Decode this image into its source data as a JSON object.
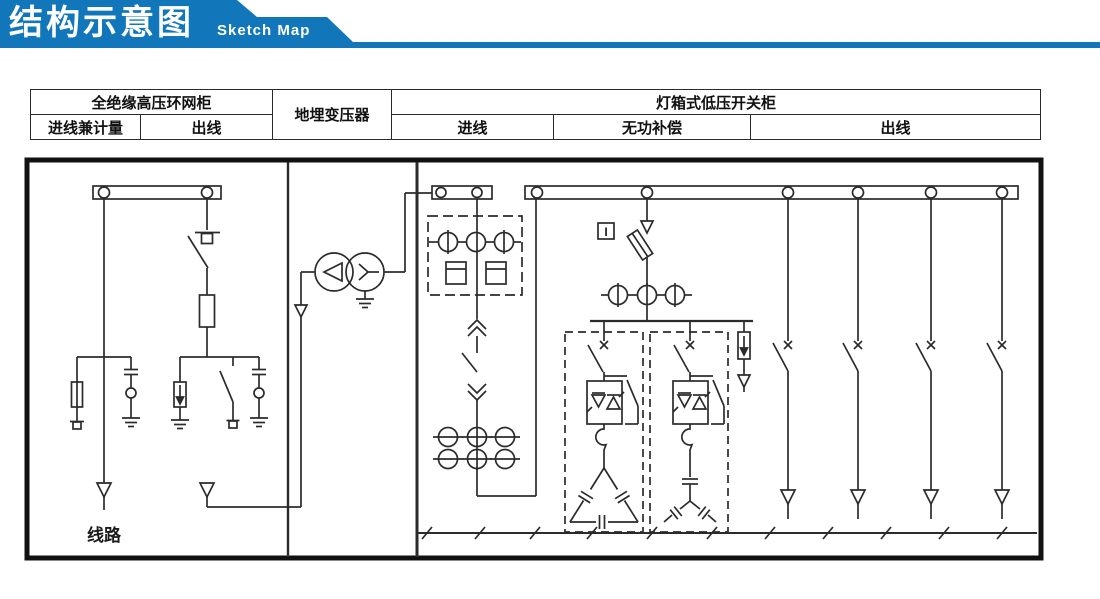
{
  "banner": {
    "title": "结构示意图",
    "subtitle": "Sketch Map",
    "color": "#1277BA"
  },
  "table": {
    "groups": [
      {
        "label": "全绝缘高压环网柜",
        "children": [
          "进线兼计量",
          "出线"
        ]
      },
      {
        "label": "地埋变压器",
        "children": []
      },
      {
        "label": "灯箱式低压开关柜",
        "children": [
          "进线",
          "无功补偿",
          "出线"
        ]
      }
    ]
  },
  "diagram": {
    "line_label": "线路",
    "ammeter_label": "I",
    "line_color": "#2b2b2b",
    "symbols": [
      "hv-busbar",
      "hv-incoming-feeder",
      "voltage-transformer-fuse",
      "capacitive-voltage-indicator",
      "load-break-switch",
      "hv-fuse",
      "surge-arrester",
      "earthing-switch",
      "line-arrow",
      "transformer-delta-wye",
      "ground",
      "lv-incoming-busbar",
      "metering-current-transformers",
      "energy-meters",
      "withdrawable-circuit-breaker",
      "current-transformers",
      "lv-main-busbar",
      "ammeter-indicator",
      "fuse-disconnector",
      "thyristor-switched-capacitor-delta",
      "thyristor-switched-capacitor-wye",
      "series-reactor",
      "lv-surge-arrester",
      "outgoing-breaker",
      "pe-earth-bar"
    ]
  }
}
